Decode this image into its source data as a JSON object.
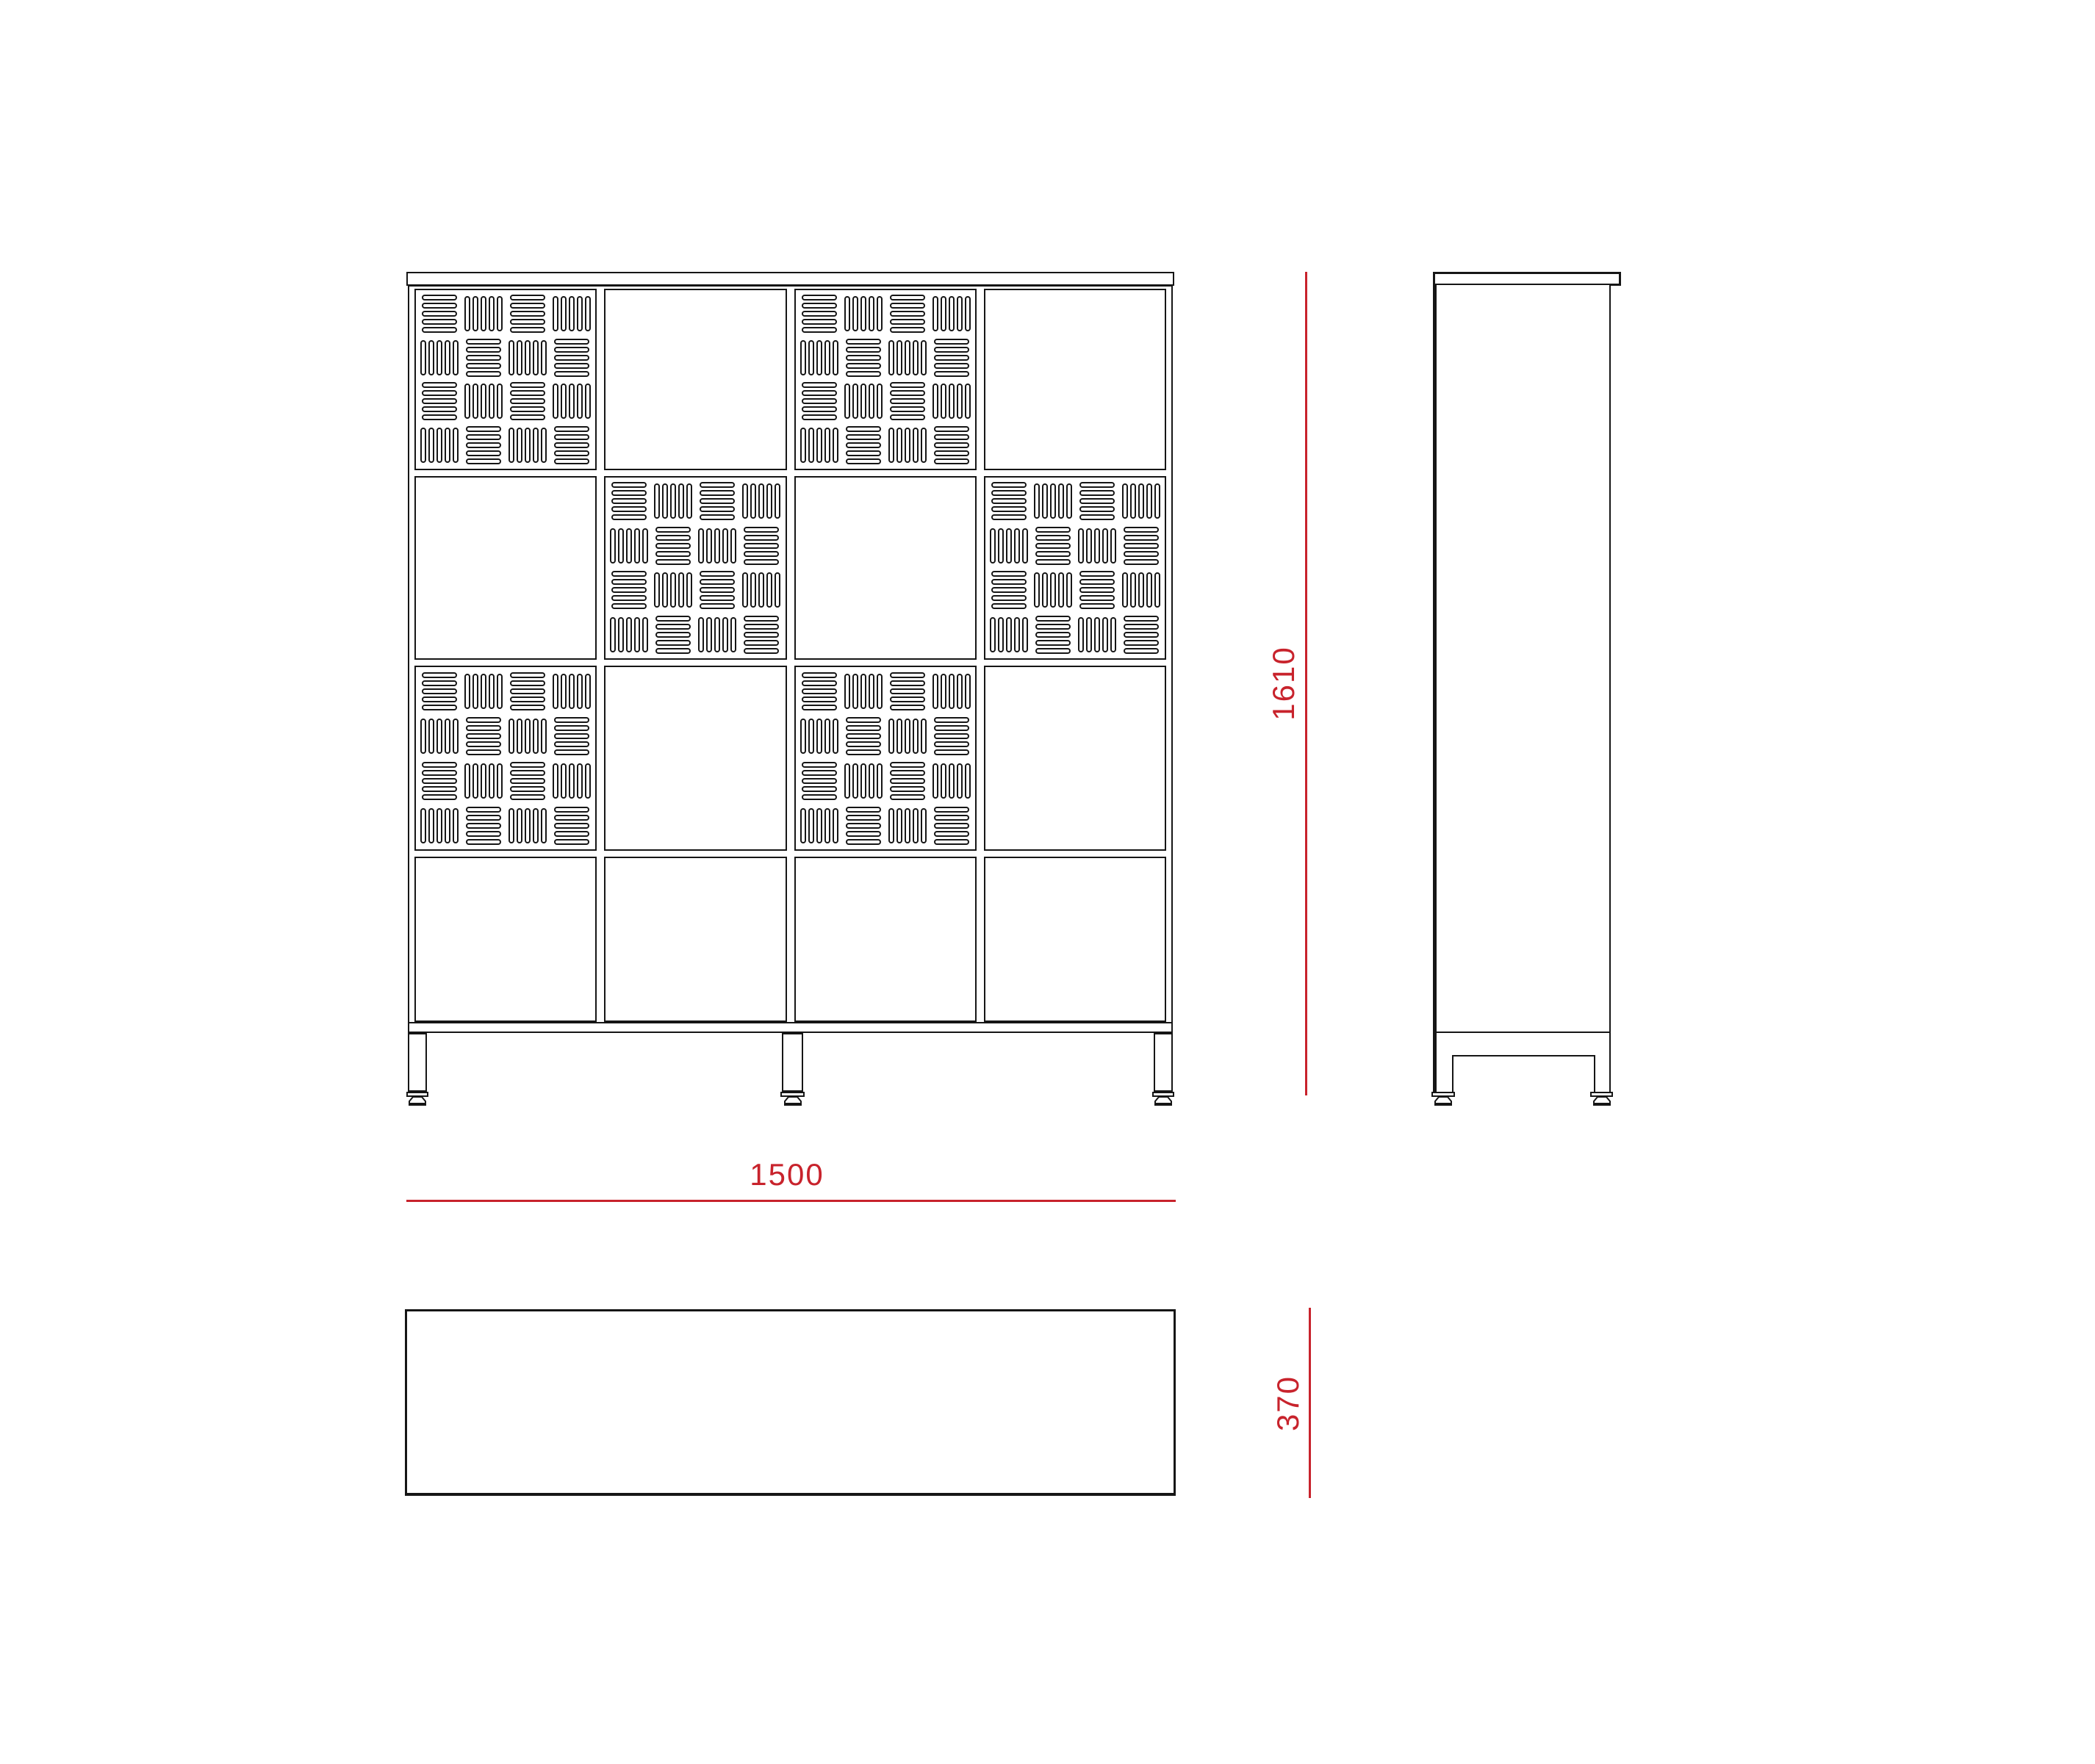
{
  "drawing": {
    "kind": "cabinet orthographic technical drawing",
    "colors": {
      "dimension_red": "#c8232c",
      "line_black": "#161616"
    },
    "dimension_labels": {
      "width": "1500",
      "height": "1610",
      "depth": "370"
    },
    "front_view": {
      "door_rows": 4,
      "door_columns": 4,
      "door_matrix": [
        [
          "perforated",
          "plain",
          "perforated",
          "plain"
        ],
        [
          "plain",
          "perforated",
          "plain",
          "perforated"
        ],
        [
          "perforated",
          "plain",
          "perforated",
          "plain"
        ],
        [
          "plain",
          "plain",
          "plain",
          "plain"
        ]
      ],
      "perforation": {
        "groups_per_row": 4,
        "groups_per_column": 4,
        "slats_per_group": 5,
        "arrangement": "checkerboard",
        "first_group": "horizontal"
      },
      "legs": 3
    },
    "side_view": {
      "legs": 2,
      "top_cap_overhang": "right"
    },
    "top_view": {
      "shape": "rectangle"
    }
  }
}
